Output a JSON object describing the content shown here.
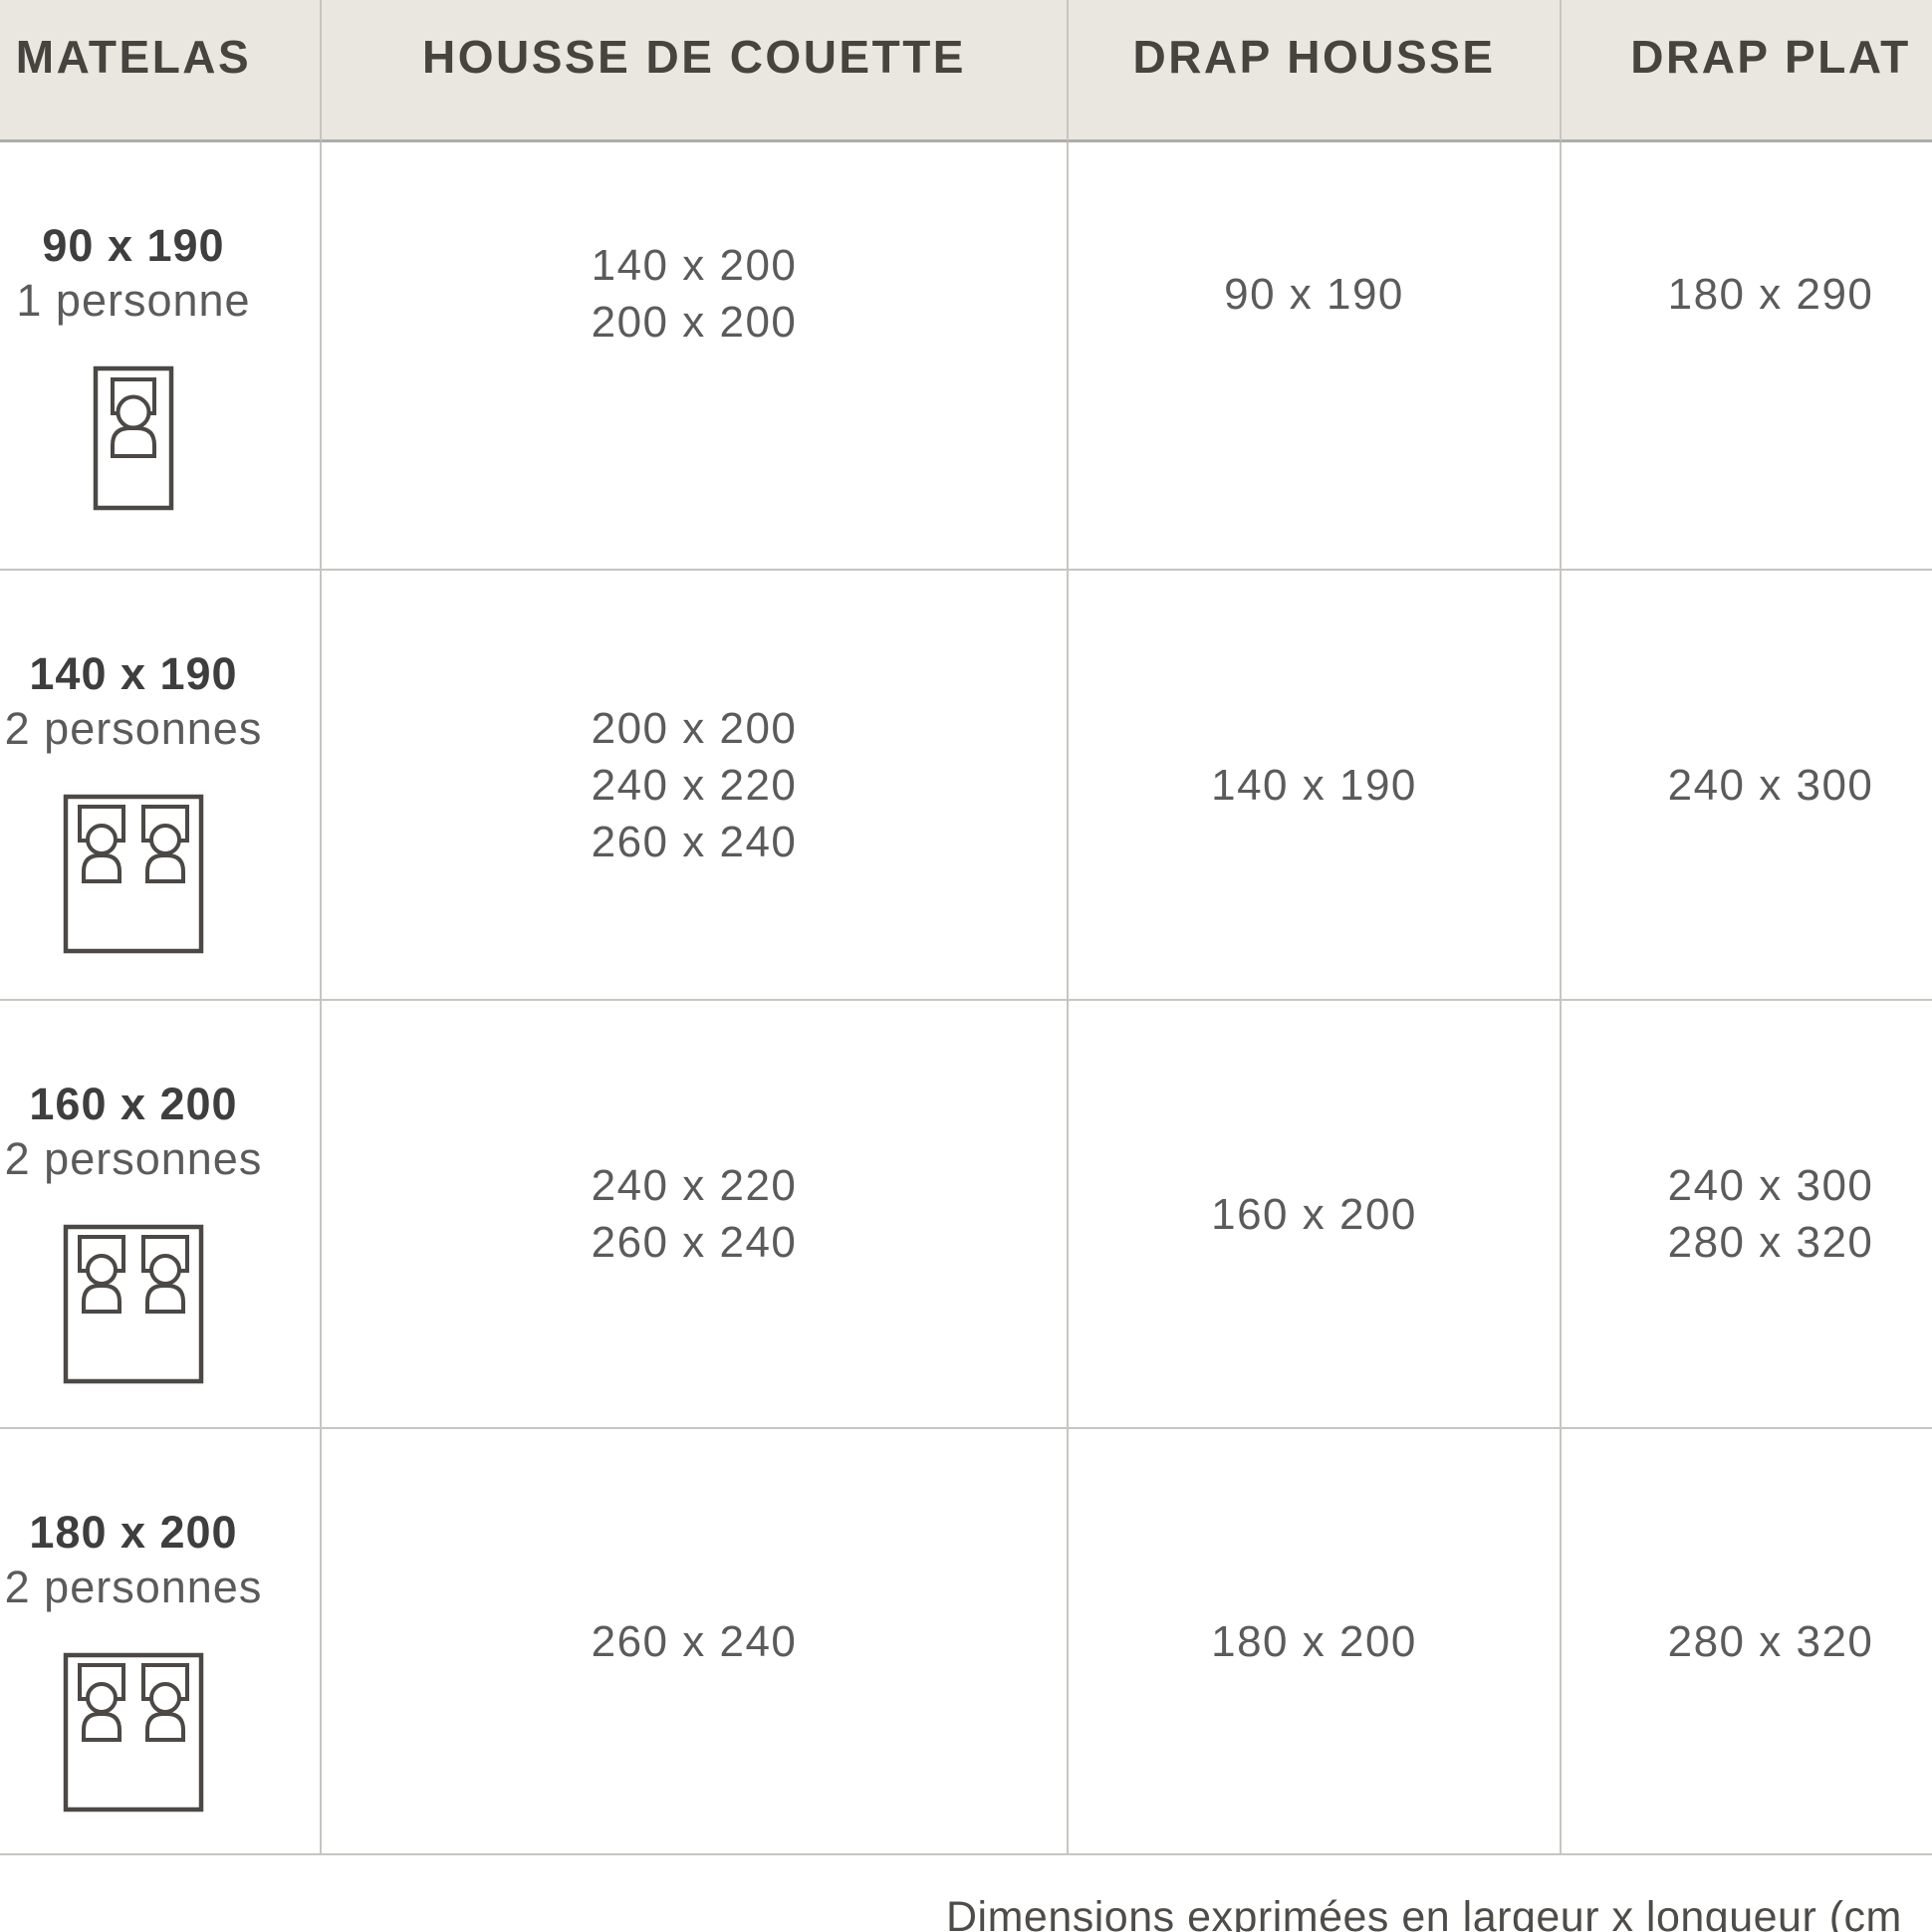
{
  "table": {
    "columns": [
      {
        "label": "MATELAS"
      },
      {
        "label": "HOUSSE DE COUETTE"
      },
      {
        "label": "DRAP HOUSSE"
      },
      {
        "label": "DRAP PLAT"
      }
    ],
    "rows": [
      {
        "matelas_size": "90 x 190",
        "capacity": "1 personne",
        "bed_icon": "single-bed-icon",
        "housse_de_couette": [
          "140 x 200",
          "200 x 200"
        ],
        "drap_housse": "90 x 190",
        "drap_plat": [
          "180 x 290"
        ]
      },
      {
        "matelas_size": "140 x 190",
        "capacity": "2 personnes",
        "bed_icon": "double-bed-icon",
        "housse_de_couette": [
          "200 x 200",
          "240 x 220",
          "260 x 240"
        ],
        "drap_housse": "140 x 190",
        "drap_plat": [
          "240 x 300"
        ]
      },
      {
        "matelas_size": "160 x 200",
        "capacity": "2 personnes",
        "bed_icon": "double-bed-icon",
        "housse_de_couette": [
          "240 x 220",
          "260 x 240"
        ],
        "drap_housse": "160 x 200",
        "drap_plat": [
          "240 x 300",
          "280 x 320"
        ]
      },
      {
        "matelas_size": "180 x 200",
        "capacity": "2 personnes",
        "bed_icon": "double-bed-icon",
        "housse_de_couette": [
          "260 x 240"
        ],
        "drap_housse": "180 x 200",
        "drap_plat": [
          "280 x 320"
        ]
      }
    ],
    "unit_note": "Dimensions exprimées en largeur x longueur (cm",
    "colors": {
      "header_background": "#eae7e1",
      "header_text": "#47433f",
      "grid_line": "#c7c5c1",
      "header_divider": "#aeaca7",
      "label_text": "#3e3e3e",
      "value_text": "#5b5b5b",
      "icon_stroke": "#4b4845",
      "note_text": "#4e4c49",
      "background": "#ffffff"
    }
  }
}
